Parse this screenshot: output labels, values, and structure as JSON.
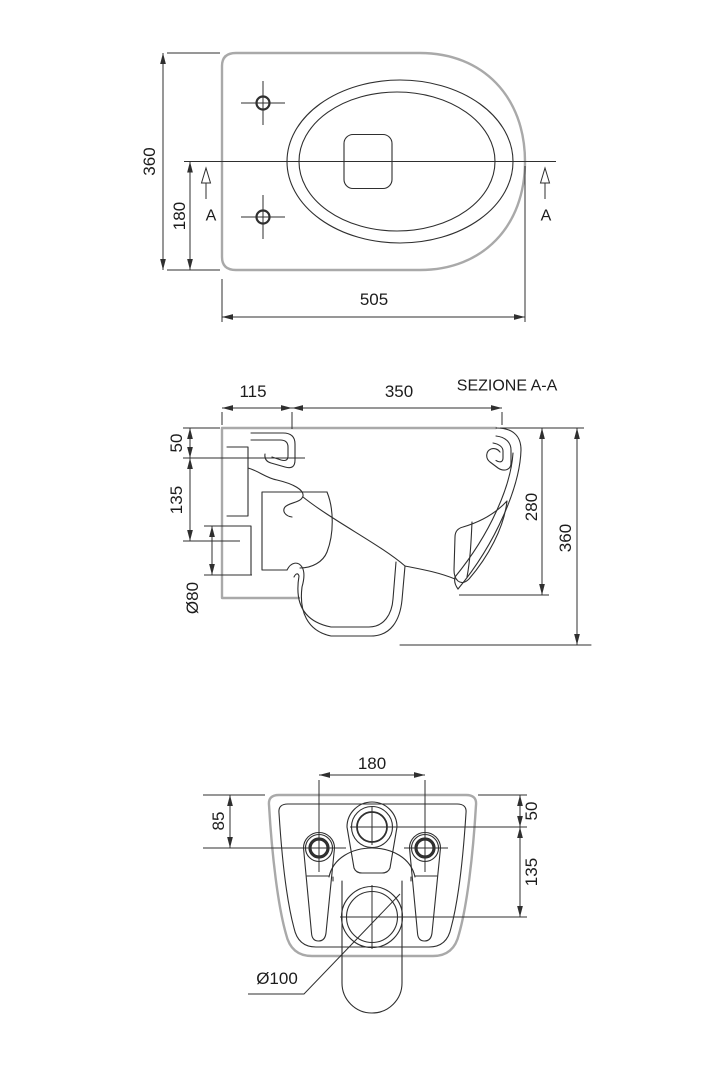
{
  "colors": {
    "background": "#ffffff",
    "body_outline_gray": "#a9a9a9",
    "detail_line": "#2f2f2f",
    "text": "#1c1c1c"
  },
  "views": {
    "top": {
      "dim_overall_depth": "360",
      "dim_axis_offset": "180",
      "dim_overall_width": "505",
      "section_marker": "A"
    },
    "section": {
      "title": "SEZIONE A-A",
      "dim_ledge": "115",
      "dim_bowl_depth": "350",
      "dim_top_to_fixing": "50",
      "dim_fixing_to_inlet": "135",
      "dim_inlet_diameter": "Ø80",
      "dim_rim_to_outlet": "280",
      "dim_overall_height": "360"
    },
    "rear": {
      "dim_hole_spacing": "180",
      "dim_top_to_holes": "85",
      "dim_top_to_inlet": "50",
      "dim_inlet_to_outlet": "135",
      "dim_outlet_diameter": "Ø100"
    }
  }
}
